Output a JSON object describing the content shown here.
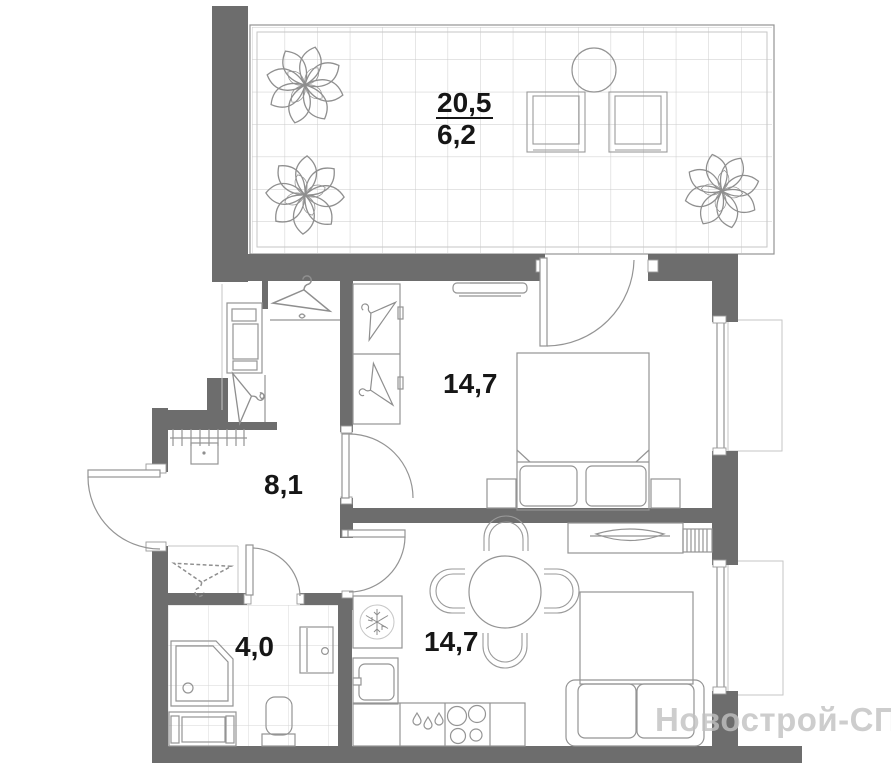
{
  "labels": {
    "balcony_total": "20,5",
    "balcony_reduced": "6,2",
    "bedroom": "14,7",
    "hallway": "8,1",
    "bathroom": "4,0",
    "kitchen_living": "14,7"
  },
  "watermark": "Новострой-СПб",
  "colors": {
    "wall": "#6d6d6d",
    "furniture_line": "#949494",
    "light_line": "#c6c6c6",
    "tile_grid": "#c9c9c9",
    "label_text": "#161616",
    "watermark_text": "#c1c1c1"
  }
}
